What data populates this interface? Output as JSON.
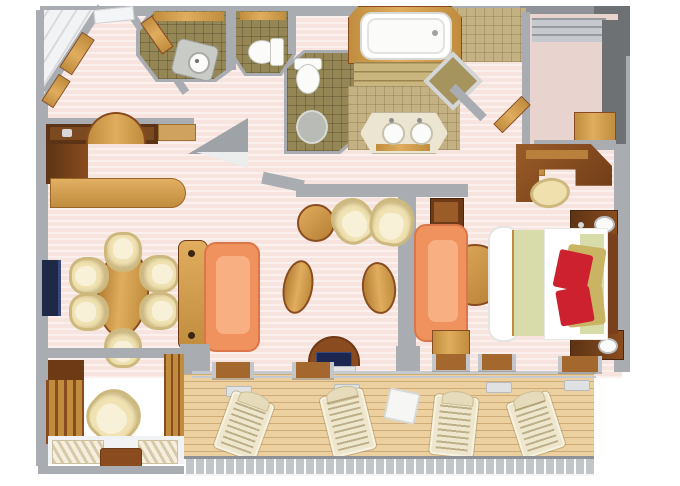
{
  "scene": {
    "kind": "suite-floor-plan-3d-top-view",
    "rooms": [
      "entry-foyer",
      "guest-bathroom",
      "guest-wc",
      "master-wc",
      "master-bathroom",
      "walk-in-closet",
      "bedroom",
      "living-room",
      "dining-area",
      "bar-pantry",
      "den-nook",
      "veranda-balcony"
    ],
    "furniture": [
      "bathtub",
      "double-vanity-sinks",
      "shower",
      "toilet",
      "sink-vanity",
      "bidet-mat",
      "king-bed",
      "nightstand-lamps",
      "writing-desk",
      "desk-stool",
      "round-table",
      "sofa",
      "loveseat",
      "oval-coffee-tables",
      "tub-chairs",
      "dining-table-for-six",
      "tv",
      "bar-counter",
      "wardrobes",
      "armchair",
      "lounge-chairs",
      "deck-table",
      "balcony-railing",
      "sliding-door-thresholds",
      "blue-cushion-chair"
    ]
  },
  "palette": {
    "wall": "#a9adb1",
    "wall_dark": "#8f9296",
    "wall_light": "#c6c9cd",
    "wall_deep": "#6e7174",
    "floor_pink": "#f7e4df",
    "tile_olive": "#958656",
    "tile_tan": "#c3b183",
    "tile_tan_dark": "#a5945e",
    "deck": "#ecd0a0",
    "wood_light": "#e0ac5e",
    "wood_mid": "#c08c3e",
    "wood_dark": "#8a4c1e",
    "wood_deep": "#5c3415",
    "cream": "#f0e2b2",
    "cream_dark": "#cdb97e",
    "sofa": "#f0925d",
    "sofa_light": "#f8b083",
    "sofa_dark": "#d9774a",
    "bed_sage": "#d8dcaa",
    "pillow_red": "#cd2130",
    "pillow_gold": "#c9b464",
    "tv_navy": "#1d2947",
    "carpet": "#e9d3cf",
    "porcelain": "#fbfbf9",
    "marble": "#ece5d2"
  }
}
